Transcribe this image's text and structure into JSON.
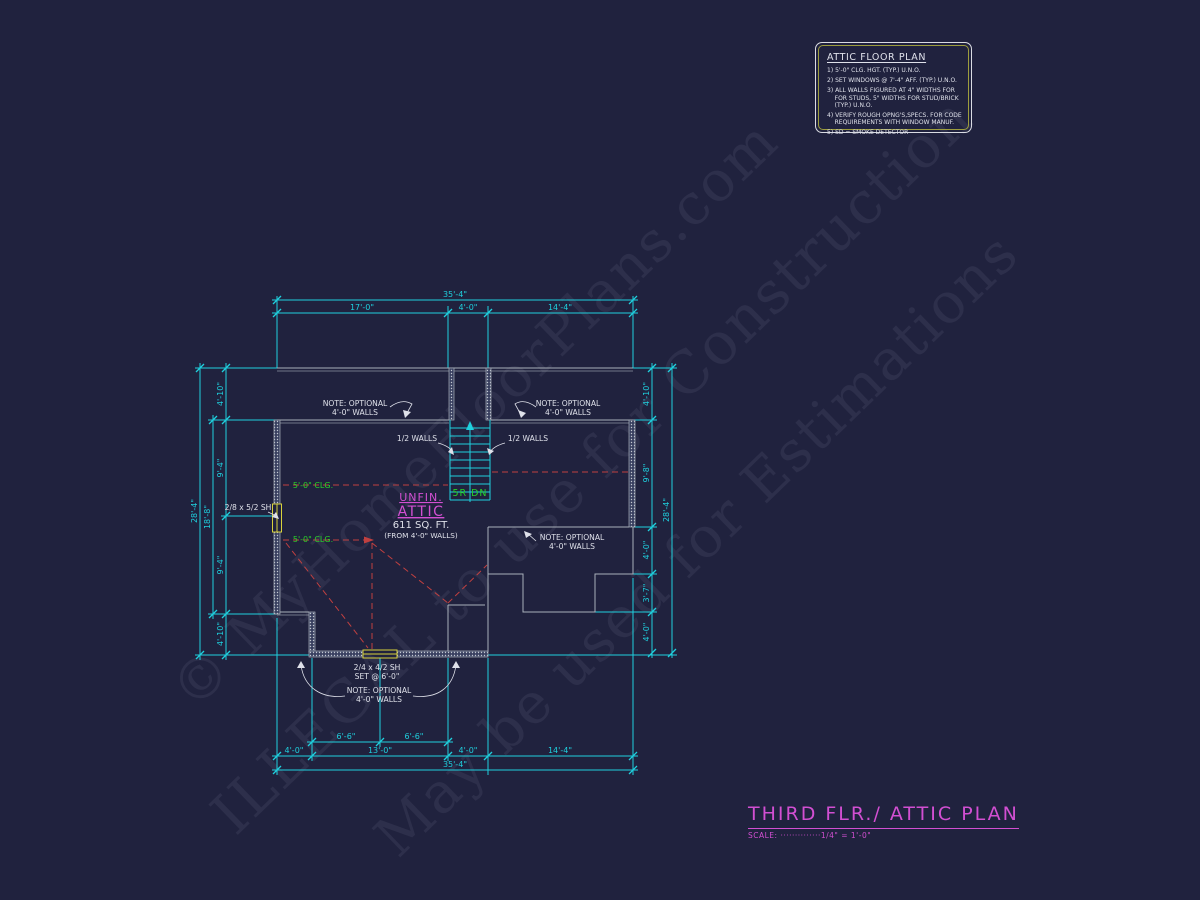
{
  "meta": {
    "background": "#20223e",
    "dim_color": "#1fd0de",
    "wall_color": "#a9b0ba",
    "text_color": "#dfe1ea",
    "accent_magenta": "#d24fd2",
    "accent_green": "#28d128",
    "accent_red": "#c04040",
    "accent_yellow": "#d8d23c"
  },
  "watermarks": [
    {
      "text": "© MyHomeFloorPlans.com"
    },
    {
      "text": "ILLEGAL to use for Construction"
    },
    {
      "text": "May be used for Estimations"
    }
  ],
  "notes_box": {
    "title": "ATTIC FLOOR PLAN",
    "notes": [
      "1) 5'-0\" CLG. HGT. (TYP.) U.N.O.",
      "2) SET WINDOWS @ 7'-4\" AFF. (TYP.) U.N.O.",
      "3) ALL WALLS FIGURED AT 4\" WIDTHS FOR\n    FOR STUDS, 5\" WIDTHS FOR STUD/BRICK\n    (TYP.) U.N.O.",
      "4) VERIFY ROUGH OPNG'S,SPECS. FOR CODE\n    REQUIREMENTS WITH WINDOW MANUF.",
      "5) SD = SMOKE DETECTOR"
    ]
  },
  "title_block": {
    "title": "THIRD FLR./ ATTIC PLAN",
    "scale": "SCALE: ··············1/4\" = 1'-0\""
  },
  "plan": {
    "room": {
      "name": "UNFIN. ATTIC",
      "area": "611 SQ. FT.",
      "area_basis": "(FROM 4'-0\" WALLS)",
      "ceiling_height": "5'-0\" CLG.",
      "stair": "5R DN"
    },
    "texts": [
      {
        "n": "dim-top-overall",
        "t": "35'-4\"",
        "x": 455,
        "y": 297,
        "c": "dim"
      },
      {
        "n": "dim-top-left",
        "t": "17'-0\"",
        "x": 362,
        "y": 310,
        "c": "dim"
      },
      {
        "n": "dim-top-stair",
        "t": "4'-0\"",
        "x": 468,
        "y": 310,
        "c": "dim"
      },
      {
        "n": "dim-top-right",
        "t": "14'-4\"",
        "x": 560,
        "y": 310,
        "c": "dim"
      },
      {
        "n": "dim-bottom-66-left",
        "t": "6'-6\"",
        "x": 346,
        "y": 739,
        "c": "dim"
      },
      {
        "n": "dim-bottom-66-right",
        "t": "6'-6\"",
        "x": 414,
        "y": 739,
        "c": "dim"
      },
      {
        "n": "dim-bottom-40-left",
        "t": "4'-0\"",
        "x": 294,
        "y": 753,
        "c": "dim"
      },
      {
        "n": "dim-bottom-130",
        "t": "13'-0\"",
        "x": 380,
        "y": 753,
        "c": "dim"
      },
      {
        "n": "dim-bottom-40-mid",
        "t": "4'-0\"",
        "x": 468,
        "y": 753,
        "c": "dim"
      },
      {
        "n": "dim-bottom-144",
        "t": "14'-4\"",
        "x": 560,
        "y": 753,
        "c": "dim"
      },
      {
        "n": "dim-bottom-overall",
        "t": "35'-4\"",
        "x": 455,
        "y": 767,
        "c": "dim"
      },
      {
        "n": "dim-left-overall",
        "t": "28'-4\"",
        "x": 197,
        "y": 511,
        "c": "dim",
        "r": -90
      },
      {
        "n": "dim-left-inner",
        "t": "18'-8\"",
        "x": 210,
        "y": 517,
        "c": "dim",
        "r": -90
      },
      {
        "n": "dim-left-seg1",
        "t": "4'-10\"",
        "x": 223,
        "y": 394,
        "c": "dim",
        "r": -90
      },
      {
        "n": "dim-left-seg2",
        "t": "9'-4\"",
        "x": 223,
        "y": 468,
        "c": "dim",
        "r": -90
      },
      {
        "n": "dim-left-seg3",
        "t": "9'-4\"",
        "x": 223,
        "y": 565,
        "c": "dim",
        "r": -90
      },
      {
        "n": "dim-left-seg4",
        "t": "4'-10\"",
        "x": 223,
        "y": 634,
        "c": "dim",
        "r": -90
      },
      {
        "n": "dim-right-seg1",
        "t": "4'-10\"",
        "x": 649,
        "y": 394,
        "c": "dim",
        "r": -90
      },
      {
        "n": "dim-right-seg2",
        "t": "9'-8\"",
        "x": 649,
        "y": 473,
        "c": "dim",
        "r": -90
      },
      {
        "n": "dim-right-seg3",
        "t": "4'-0\"",
        "x": 649,
        "y": 550,
        "c": "dim",
        "r": -90
      },
      {
        "n": "dim-right-seg4",
        "t": "3'-7\"",
        "x": 649,
        "y": 593,
        "c": "dim",
        "r": -90
      },
      {
        "n": "dim-right-seg5",
        "t": "4'-0\"",
        "x": 649,
        "y": 632,
        "c": "dim",
        "r": -90
      },
      {
        "n": "dim-right-overall",
        "t": "28'-4\"",
        "x": 669,
        "y": 510,
        "c": "dim",
        "r": -90
      },
      {
        "n": "note-optional-topleft-line1",
        "t": "NOTE: OPTIONAL",
        "x": 355,
        "y": 406,
        "c": "note"
      },
      {
        "n": "note-optional-topleft-line2",
        "t": "4'-0\" WALLS",
        "x": 355,
        "y": 415,
        "c": "note"
      },
      {
        "n": "note-optional-topright-line1",
        "t": "NOTE: OPTIONAL",
        "x": 568,
        "y": 406,
        "c": "note"
      },
      {
        "n": "note-optional-topright-line2",
        "t": "4'-0\" WALLS",
        "x": 568,
        "y": 415,
        "c": "note"
      },
      {
        "n": "label-half-walls-left",
        "t": "1/2 WALLS",
        "x": 417,
        "y": 441,
        "c": "note"
      },
      {
        "n": "label-half-walls-right",
        "t": "1/2 WALLS",
        "x": 528,
        "y": 441,
        "c": "note"
      },
      {
        "n": "label-window-left",
        "t": "2/8 x 5/2 SH",
        "x": 248,
        "y": 510,
        "c": "note"
      },
      {
        "n": "label-clg-upper",
        "t": "5'-0\" CLG.",
        "x": 313,
        "y": 488,
        "c": "clg"
      },
      {
        "n": "label-clg-lower",
        "t": "5'-0\" CLG.",
        "x": 313,
        "y": 542,
        "c": "clg"
      },
      {
        "n": "label-stair-run",
        "t": "5R DN",
        "x": 470,
        "y": 496,
        "c": "stair"
      },
      {
        "n": "room-name-line1",
        "t": "UNFIN.",
        "x": 421,
        "y": 501,
        "c": "room1"
      },
      {
        "n": "room-name-line2",
        "t": "ATTIC",
        "x": 421,
        "y": 516,
        "c": "room2"
      },
      {
        "n": "room-area",
        "t": "611 SQ. FT.",
        "x": 421,
        "y": 528,
        "c": "area"
      },
      {
        "n": "room-area-note",
        "t": "(FROM 4'-0\" WALLS)",
        "x": 421,
        "y": 538,
        "c": "areanote"
      },
      {
        "n": "label-window-bottom-line1",
        "t": "2/4 x 4/2 SH",
        "x": 377,
        "y": 670,
        "c": "note"
      },
      {
        "n": "label-window-bottom-line2",
        "t": "SET @ 6'-0\"",
        "x": 377,
        "y": 679,
        "c": "note"
      },
      {
        "n": "note-optional-bottom-line1",
        "t": "NOTE: OPTIONAL",
        "x": 379,
        "y": 693,
        "c": "note"
      },
      {
        "n": "note-optional-bottom-line2",
        "t": "4'-0\" WALLS",
        "x": 379,
        "y": 702,
        "c": "note"
      },
      {
        "n": "note-optional-midright-line1",
        "t": "NOTE: OPTIONAL",
        "x": 572,
        "y": 540,
        "c": "note"
      },
      {
        "n": "note-optional-midright-line2",
        "t": "4'-0\" WALLS",
        "x": 572,
        "y": 549,
        "c": "note"
      }
    ]
  }
}
